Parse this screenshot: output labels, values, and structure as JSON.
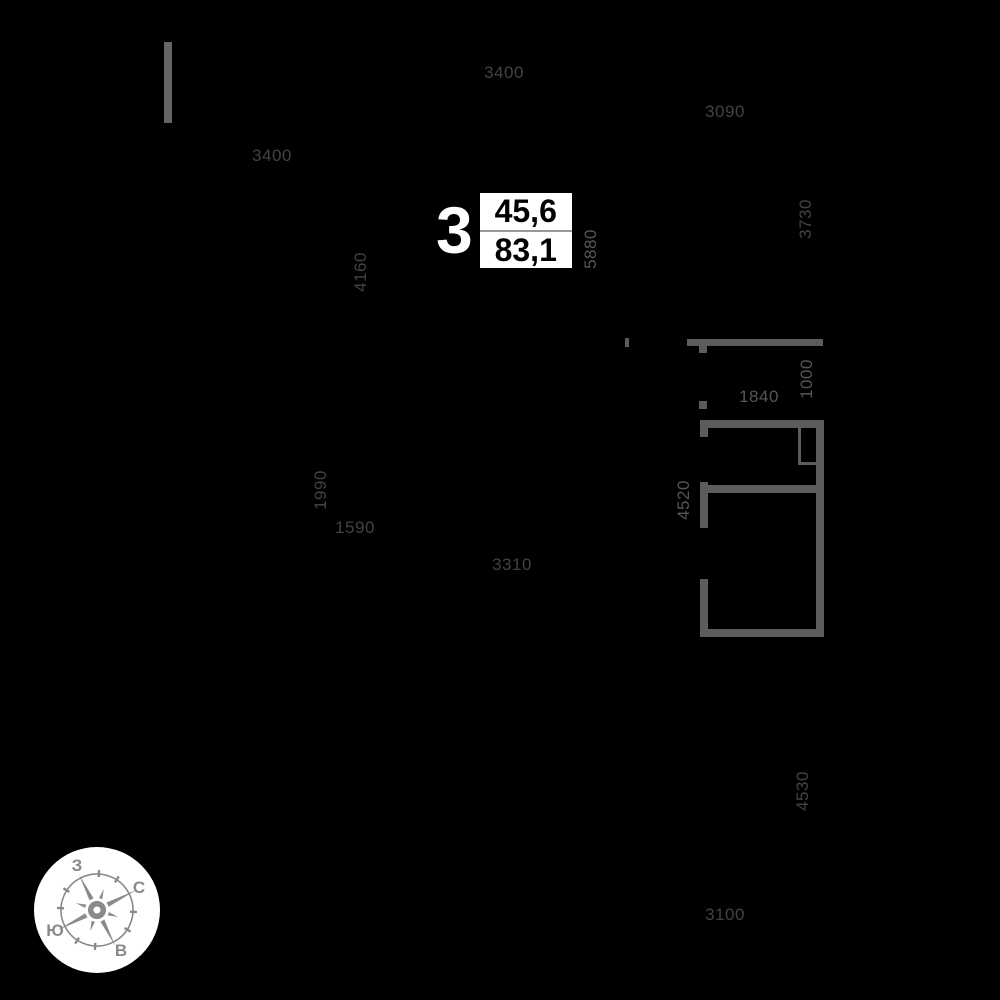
{
  "page": {
    "kind": "apartment-floor-plan",
    "background": "black"
  },
  "colors": {
    "bg": "#000000",
    "wall": "#5c5c5c",
    "wall-light": "#656565",
    "dim": "#434343",
    "dim-light": "#565656",
    "compass": "#8a8a8a",
    "box-bg": "#ffffff",
    "box-text": "#000000",
    "box-divider": "#999999",
    "unit-number": "#ffffff"
  },
  "unit": {
    "number": "3",
    "area_upper": "45,6",
    "area_lower": "83,1"
  },
  "dimensions_mm": [
    {
      "value": "3400",
      "orientation": "horizontal",
      "location": "top-center"
    },
    {
      "value": "3090",
      "orientation": "horizontal",
      "location": "top-right"
    },
    {
      "value": "3400",
      "orientation": "horizontal",
      "location": "upper-left"
    },
    {
      "value": "3730",
      "orientation": "vertical",
      "location": "right-upper"
    },
    {
      "value": "4160",
      "orientation": "vertical",
      "location": "center-left"
    },
    {
      "value": "5880",
      "orientation": "vertical",
      "location": "center-near-area-box"
    },
    {
      "value": "1000",
      "orientation": "vertical",
      "location": "above-apartment-right"
    },
    {
      "value": "1840",
      "orientation": "horizontal",
      "location": "above-apartment"
    },
    {
      "value": "4520",
      "orientation": "vertical",
      "location": "left-of-apartment"
    },
    {
      "value": "1990",
      "orientation": "vertical",
      "location": "mid-left"
    },
    {
      "value": "1590",
      "orientation": "horizontal",
      "location": "mid-left"
    },
    {
      "value": "3310",
      "orientation": "horizontal",
      "location": "mid-center"
    },
    {
      "value": "4530",
      "orientation": "vertical",
      "location": "lower-right"
    },
    {
      "value": "3100",
      "orientation": "horizontal",
      "location": "bottom-right"
    }
  ],
  "compass": {
    "labels": {
      "west": "З",
      "north": "С",
      "south": "Ю",
      "east": "В"
    }
  }
}
